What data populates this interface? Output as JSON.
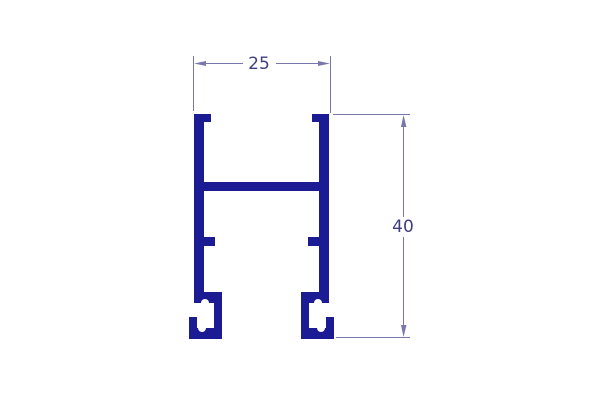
{
  "drawing": {
    "background_color": "#ffffff",
    "profile_color": "#1b1b94",
    "notch_color": "#ffffff",
    "dimension_line_color": "#7878ad",
    "dimension_label_color": "#3f3f80",
    "dimensions": {
      "width": {
        "label": "25"
      },
      "height": {
        "label": "40"
      }
    }
  }
}
